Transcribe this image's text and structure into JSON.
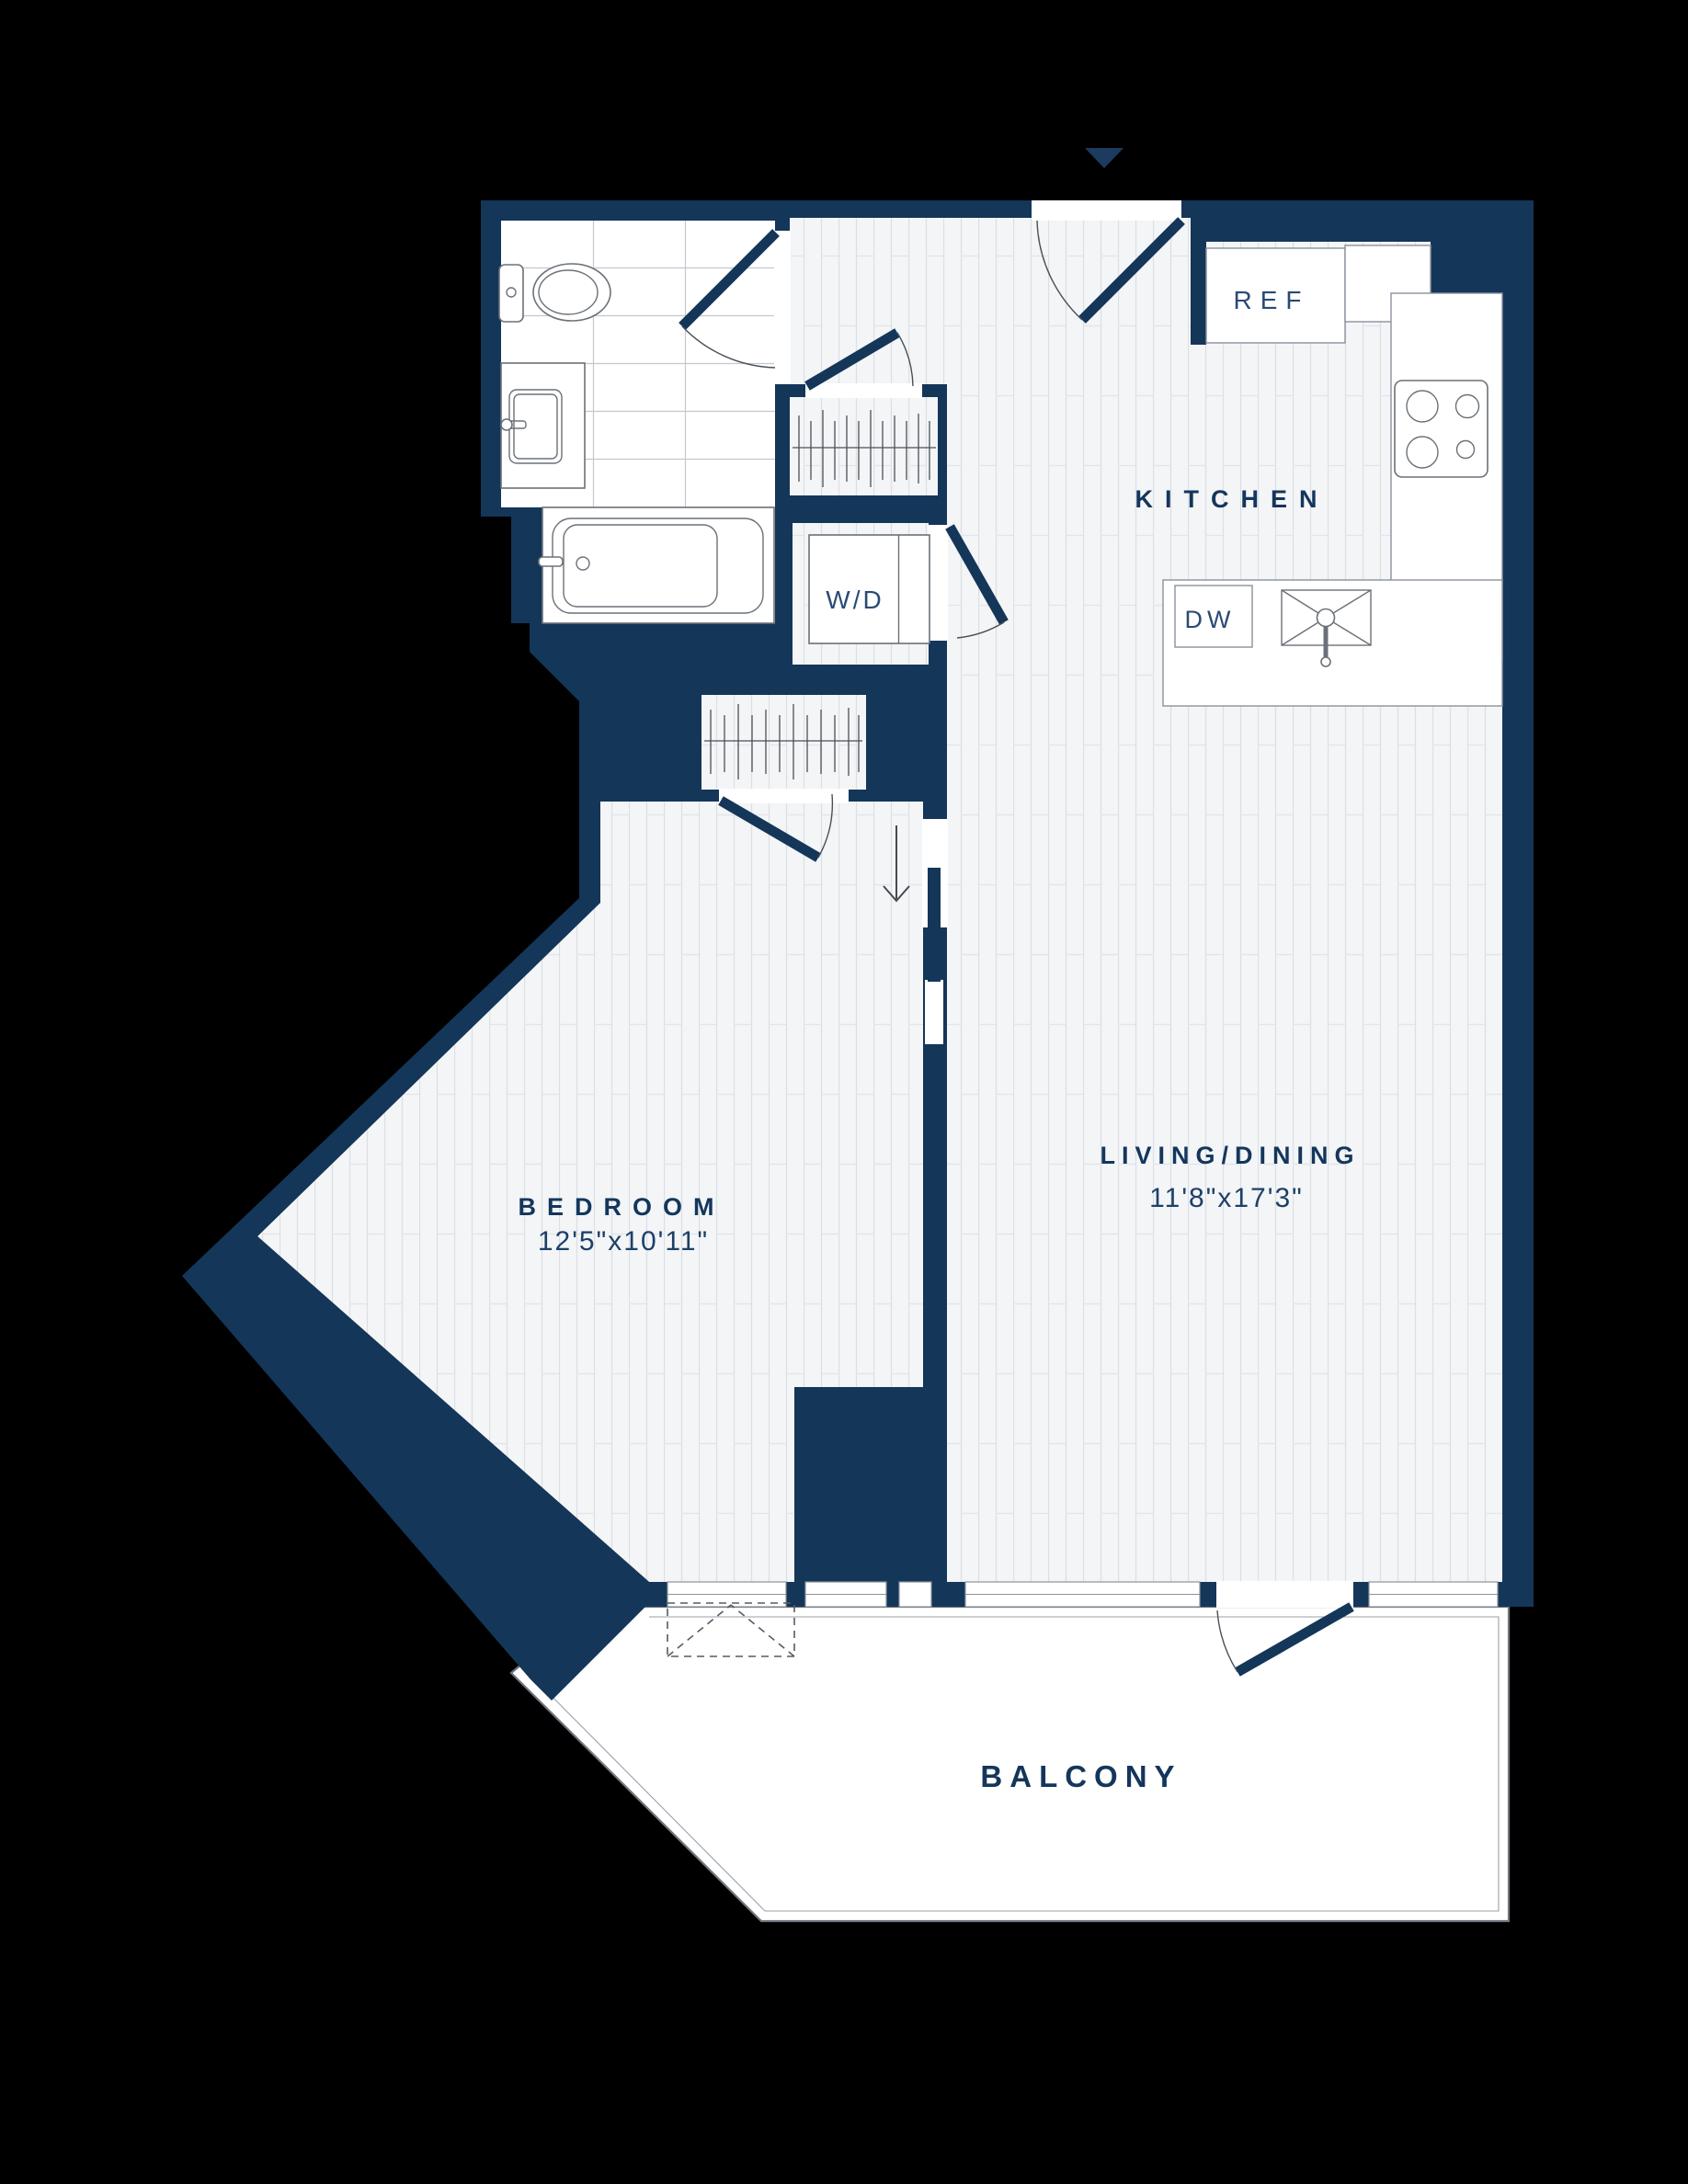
{
  "title": "Apartment floor plan",
  "labels": {
    "kitchen": "KITCHEN",
    "living_dining": "LIVING/DINING",
    "living_dining_dims": "11'8\"x17'3\"",
    "bedroom": "BEDROOM",
    "bedroom_dims": "12'5\"x10'11\"",
    "balcony": "BALCONY",
    "refrigerator": "REF",
    "washer_dryer": "W/D",
    "dishwasher": "DW"
  },
  "rooms": [
    {
      "name": "kitchen",
      "label": "KITCHEN"
    },
    {
      "name": "living_dining",
      "label": "LIVING/DINING",
      "dimensions": "11'8\"x17'3\""
    },
    {
      "name": "bedroom",
      "label": "BEDROOM",
      "dimensions": "12'5\"x10'11\""
    },
    {
      "name": "balcony",
      "label": "BALCONY"
    }
  ],
  "appliances": [
    {
      "name": "refrigerator",
      "label": "REF"
    },
    {
      "name": "washer_dryer",
      "label": "W/D"
    },
    {
      "name": "dishwasher",
      "label": "DW"
    }
  ],
  "colors": {
    "wall": "#143659",
    "floor_base": "#f3f5f7",
    "plank_line": "#dcdfe4",
    "tile_line": "#c3c8cf",
    "fixture_outline": "#6b7178",
    "counter_outline": "#8a929c",
    "label": "#14365c",
    "background": "#000000"
  }
}
